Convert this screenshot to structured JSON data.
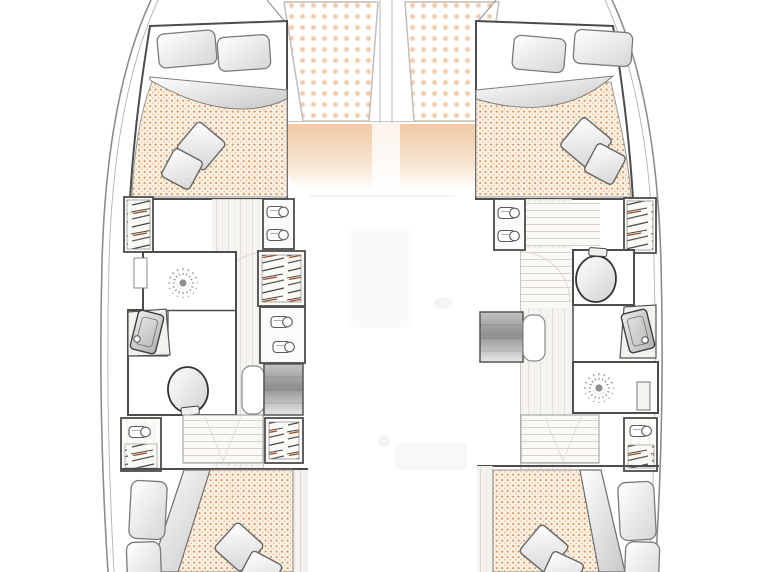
{
  "meta": {
    "type": "floor-plan",
    "subject": "catamaran interior layout, hull level, bow up",
    "cabins_visible": 4,
    "bathrooms_visible": 2,
    "trampolines_visible": 2
  },
  "colors": {
    "background": "#ffffff",
    "wall": "#4c4c4c",
    "hull_outline": "#8d8d8d",
    "mattress_base": "#faf0e2",
    "mattress_dot": "#de7f3e",
    "trampoline_dot": "#f0c7a6",
    "foredeck": "#f0c29c",
    "wood_floor": "#f4f2ee",
    "wood_grain": "#ddd9d2",
    "hatch_dark": "#4a4a4a",
    "hatch_rust": "#a04a1e",
    "stairs_dark": "#8f8f8f",
    "pillow_shade": "#d6d6d6"
  },
  "bow": {
    "trampolines": [
      {
        "name": "port-trampoline"
      },
      {
        "name": "starboard-trampoline"
      }
    ],
    "foredeck_cushion": {
      "name": "foredeck-lounge"
    }
  },
  "port_hull": {
    "forward_cabin": {
      "bed": "double berth",
      "pillows": 2,
      "cushions": 2,
      "duvet": "folded"
    },
    "bathroom": {
      "fixtures": [
        "shower",
        "washbasin",
        "toilet"
      ]
    },
    "storage": [
      "outboard-wardrobe",
      "shelf-unit-fwd",
      "hanging-locker-mid",
      "shelf-unit-mid",
      "hanging-locker-aft",
      "outboard-locker-aft"
    ],
    "stairs": "companionway-from-saloon",
    "aft_cabin": {
      "bed": "double berth",
      "pillows": 2,
      "cushions": 2,
      "duvet": "folded"
    }
  },
  "starboard_hull": {
    "forward_cabin": {
      "bed": "double berth",
      "pillows": 2,
      "cushions": 2,
      "duvet": "folded"
    },
    "bathroom": {
      "fixtures": [
        "toilet",
        "washbasin",
        "shower"
      ]
    },
    "storage": [
      "shelf-unit-fwd",
      "outboard-wardrobe",
      "outboard-locker-aft"
    ],
    "stairs": "companionway-from-saloon",
    "aft_cabin": {
      "bed": "double berth",
      "pillows": 2,
      "cushions": 2,
      "duvet": "folded"
    }
  }
}
